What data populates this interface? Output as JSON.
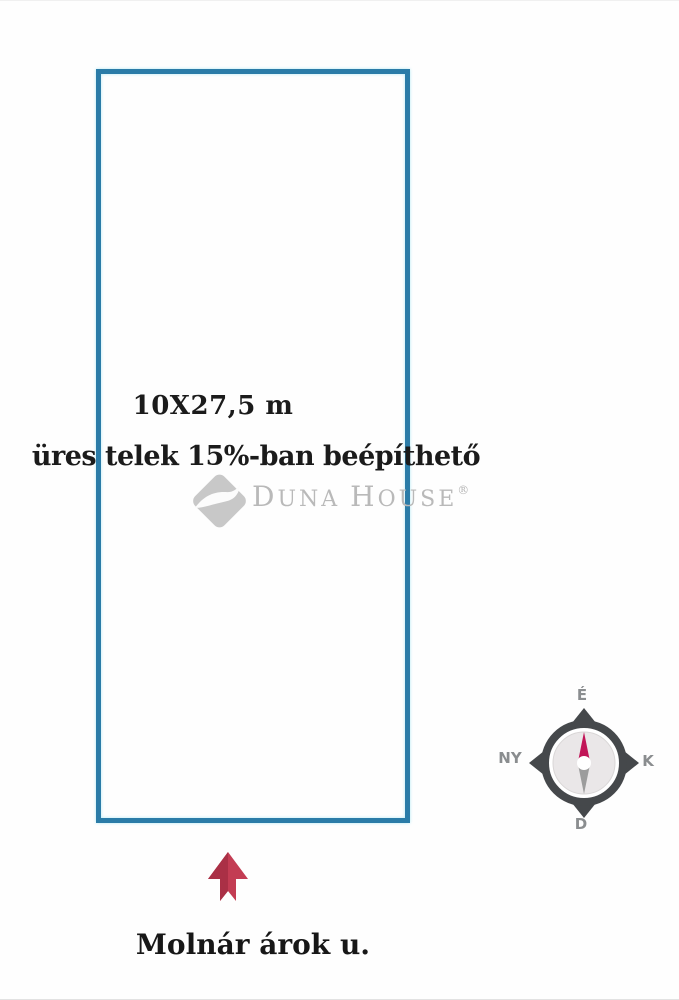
{
  "plot": {
    "dimensions_label": "10X27,5 m",
    "zoning_label": "üres telek 15%-ban beépíthető",
    "border_color": "#2b7ca8"
  },
  "watermark": {
    "brand_first_caps": "D",
    "brand_first_rest": "UNA",
    "brand_second_caps": "H",
    "brand_second_rest": "OUSE",
    "registered_mark": "®",
    "text_color": "#b9b9b9",
    "logo_color": "#c8c8c8",
    "logo_wave_color": "#fcfcfc"
  },
  "compass": {
    "north_label": "É",
    "east_label": "K",
    "south_label": "D",
    "west_label": "NY",
    "ring_color": "#45484b",
    "label_color": "#8a8d8f",
    "face_color": "#eae7e8",
    "face_edge_color": "#d9d6d6",
    "needle_north_color": "#c11557",
    "needle_south_color": "#9c9c9c"
  },
  "street": {
    "name_label": "Molnár árok u.",
    "arrow_color": "#c33c53",
    "arrow_shadow_color": "#aa3046",
    "arrow_direction": "up"
  }
}
